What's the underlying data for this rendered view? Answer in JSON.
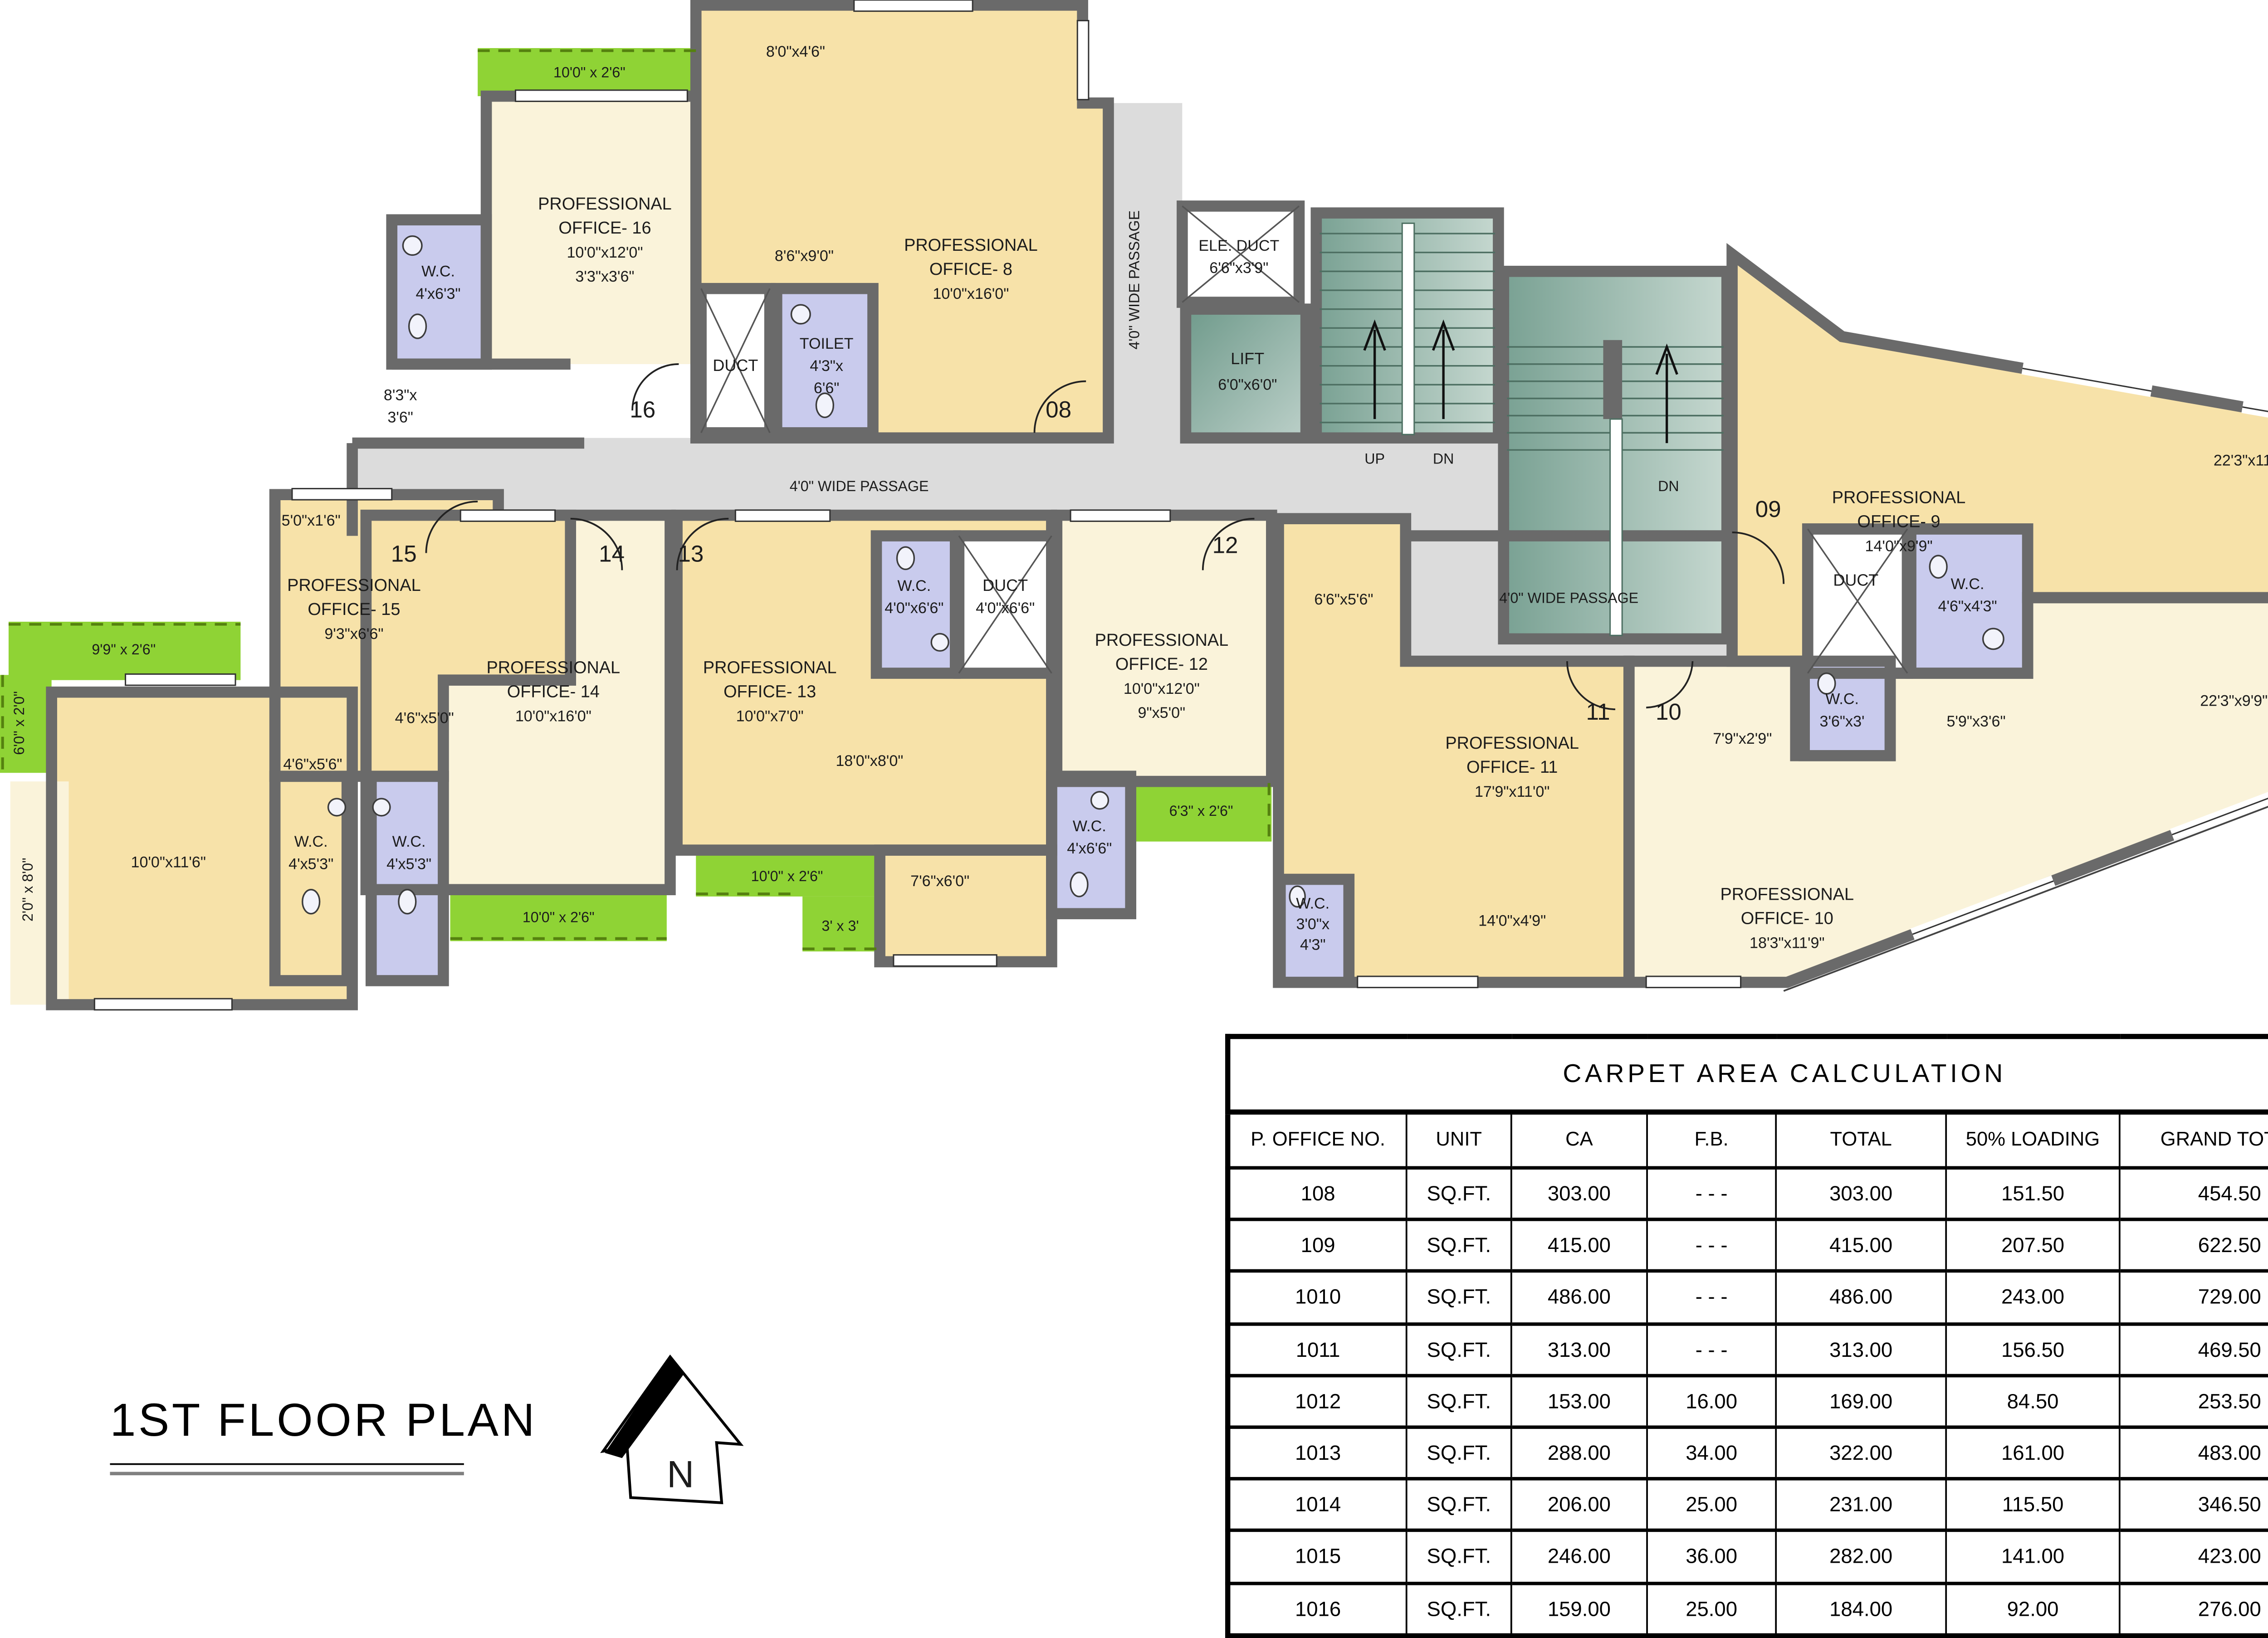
{
  "page": {
    "plan_title": "1ST FLOOR PLAN",
    "north": "N"
  },
  "plan": {
    "passages": {
      "main": "4'0\" WIDE PASSAGE",
      "east": "4'0\" WIDE PASSAGE",
      "vert": "4'0\" WIDE PASSAGE"
    },
    "offices": {
      "o8": {
        "n1": "PROFESSIONAL",
        "n2": "OFFICE- 8",
        "d": "10'0\"x16'0\"",
        "s1": "8'0\"x4'6\"",
        "s2": "8'6\"x9'0\""
      },
      "o9": {
        "n1": "PROFESSIONAL",
        "n2": "OFFICE- 9",
        "d": "14'0\"x9'9\"",
        "s1": "22'3\"x11'6\""
      },
      "o10": {
        "n1": "PROFESSIONAL",
        "n2": "OFFICE- 10",
        "d": "18'3\"x11'9\"",
        "s1": "7'9\"x2'9\"",
        "s2": "5'9\"x3'6\"",
        "s3": "22'3\"x9'9\""
      },
      "o11": {
        "n1": "PROFESSIONAL",
        "n2": "OFFICE- 11",
        "d": "17'9\"x11'0\"",
        "s1": "6'6\"x5'6\"",
        "s2": "14'0\"x4'9\""
      },
      "o12": {
        "n1": "PROFESSIONAL",
        "n2": "OFFICE- 12",
        "d": "10'0\"x12'0\"",
        "d2": "9\"x5'0\""
      },
      "o13": {
        "n1": "PROFESSIONAL",
        "n2": "OFFICE- 13",
        "d": "10'0\"x7'0\"",
        "s1": "18'0\"x8'0\"",
        "s2": "7'6\"x6'0\""
      },
      "o14": {
        "n1": "PROFESSIONAL",
        "n2": "OFFICE- 14",
        "d": "10'0\"x16'0\"",
        "s1": "4'6\"x5'0\""
      },
      "o15": {
        "n1": "PROFESSIONAL",
        "n2": "OFFICE- 15",
        "d": "9'3\"x6'6\"",
        "s1": "5'0\"x1'6\"",
        "s2": "4'6\"x5'6\"",
        "s3": "10'0\"x11'6\"",
        "s4": "2'0\" x 8'0\"",
        "s5": "6'0\" x 2'0\"",
        "s6": "9'9\" x 2'6\""
      },
      "o16": {
        "n1": "PROFESSIONAL",
        "n2": "OFFICE- 16",
        "d": "10'0\"x12'0\"",
        "d2": "3'3\"x3'6\"",
        "s1": "8'3\"x",
        "s2": "3'6\""
      }
    },
    "wet": {
      "wc16": {
        "n": "W.C.",
        "d": "4'x6'3\""
      },
      "toilet8": {
        "n": "TOILET",
        "d1": "4'3\"x",
        "d2": "6'6\""
      },
      "wc15a": {
        "n": "W.C.",
        "d": "4'x5'3\""
      },
      "wc15b": {
        "n": "W.C.",
        "d": "4'x5'3\""
      },
      "wc13": {
        "n": "W.C.",
        "d": "4'0\"x6'6\""
      },
      "wc12": {
        "n": "W.C.",
        "d": "4'x6'6\""
      },
      "wc11": {
        "n": "W.C.",
        "d1": "3'0\"x",
        "d2": "4'3\""
      },
      "wc9": {
        "n": "W.C.",
        "d": "4'6\"x4'3\""
      },
      "wc10": {
        "n": "W.C.",
        "d": "3'6\"x3'"
      }
    },
    "service": {
      "duct8": "DUCT",
      "duct13": {
        "n": "DUCT",
        "d": "4'0\"x6'6\""
      },
      "wc13lbl": {
        "n": "W.C.",
        "d": "4'0\"x6'6\""
      },
      "duct9": "DUCT",
      "ele": {
        "n": "ELE. DUCT",
        "d": "6'6\"x3'9\""
      },
      "lift": {
        "n": "LIFT",
        "d": "6'0\"x6'0\""
      },
      "up": "UP",
      "dn1": "DN",
      "dn2": "DN"
    },
    "balconies": {
      "b16": "10'0\" x 2'6\"",
      "b14": "10'0\" x 2'6\"",
      "b13": "10'0\" x 2'6\"",
      "b13s": "3' x 3'",
      "b12": "6'3\" x 2'6\""
    },
    "terrace": {
      "n": "TERRACE",
      "d": "18'6\"x13'6\""
    },
    "doors": {
      "d08": "08",
      "d09": "09",
      "d10": "10",
      "d11": "11",
      "d12": "12",
      "d13": "13",
      "d14": "14",
      "d15": "15",
      "d16": "16"
    }
  },
  "table": {
    "title": "CARPET  AREA  CALCULATION",
    "headers": [
      "P. OFFICE NO.",
      "UNIT",
      "CA",
      "F.B.",
      "TOTAL",
      "50% LOADING",
      "GRAND TOTAL",
      "TERRACE"
    ],
    "rows": [
      [
        "108",
        "SQ.FT.",
        "303.00",
        "- - -",
        "303.00",
        "151.50",
        "454.50",
        "- - -"
      ],
      [
        "109",
        "SQ.FT.",
        "415.00",
        "- - -",
        "415.00",
        "207.50",
        "622.50",
        "- - -"
      ],
      [
        "1010",
        "SQ.FT.",
        "486.00",
        "- - -",
        "486.00",
        "243.00",
        "729.00",
        "248.00"
      ],
      [
        "1011",
        "SQ.FT.",
        "313.00",
        "- - -",
        "313.00",
        "156.50",
        "469.50",
        "- - -"
      ],
      [
        "1012",
        "SQ.FT.",
        "153.00",
        "16.00",
        "169.00",
        "84.50",
        "253.50",
        "- - -"
      ],
      [
        "1013",
        "SQ.FT.",
        "288.00",
        "34.00",
        "322.00",
        "161.00",
        "483.00",
        "- - -"
      ],
      [
        "1014",
        "SQ.FT.",
        "206.00",
        "25.00",
        "231.00",
        "115.50",
        "346.50",
        "- - -"
      ],
      [
        "1015",
        "SQ.FT.",
        "246.00",
        "36.00",
        "282.00",
        "141.00",
        "423.00",
        "- - -"
      ],
      [
        "1016",
        "SQ.FT.",
        "159.00",
        "25.00",
        "184.00",
        "92.00",
        "276.00",
        "- - -"
      ]
    ]
  }
}
